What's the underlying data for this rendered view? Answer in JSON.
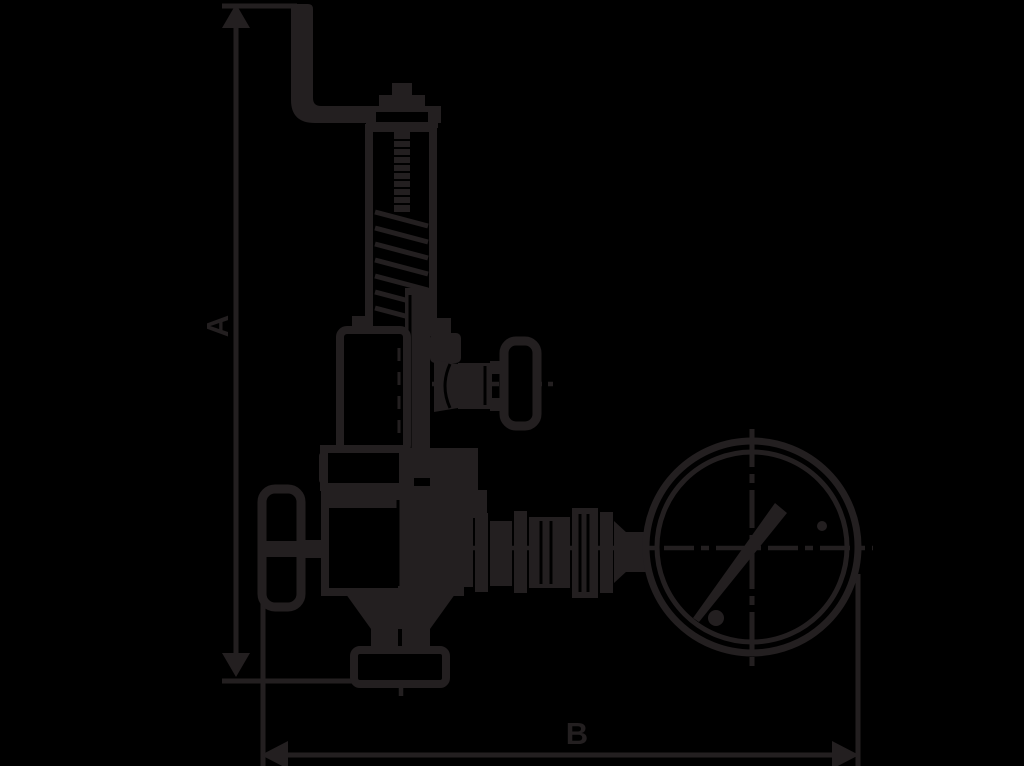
{
  "page": {
    "background_color": "#000000",
    "line_color": "#231f20"
  },
  "drawing": {
    "title": "Dimensioned side-view line drawing of a spring-loaded relief/regulating valve with lifting lever, side handwheel, left handwheel, outlet fittings and pressure gauge",
    "dimension_a": {
      "label": "A",
      "orientation": "vertical",
      "position": "left"
    },
    "dimension_b": {
      "label": "B",
      "orientation": "horizontal",
      "position": "bottom"
    },
    "components": [
      "lifting-lever",
      "cap-knob",
      "spring-housing",
      "adjusting-rod",
      "spring-coils",
      "bonnet",
      "yoke",
      "side-handwheel",
      "left-handwheel",
      "valve-body",
      "mid-flange",
      "bottom-flange",
      "outlet-fittings",
      "pressure-gauge",
      "gauge-needle",
      "gauge-screws",
      "centerlines"
    ]
  }
}
